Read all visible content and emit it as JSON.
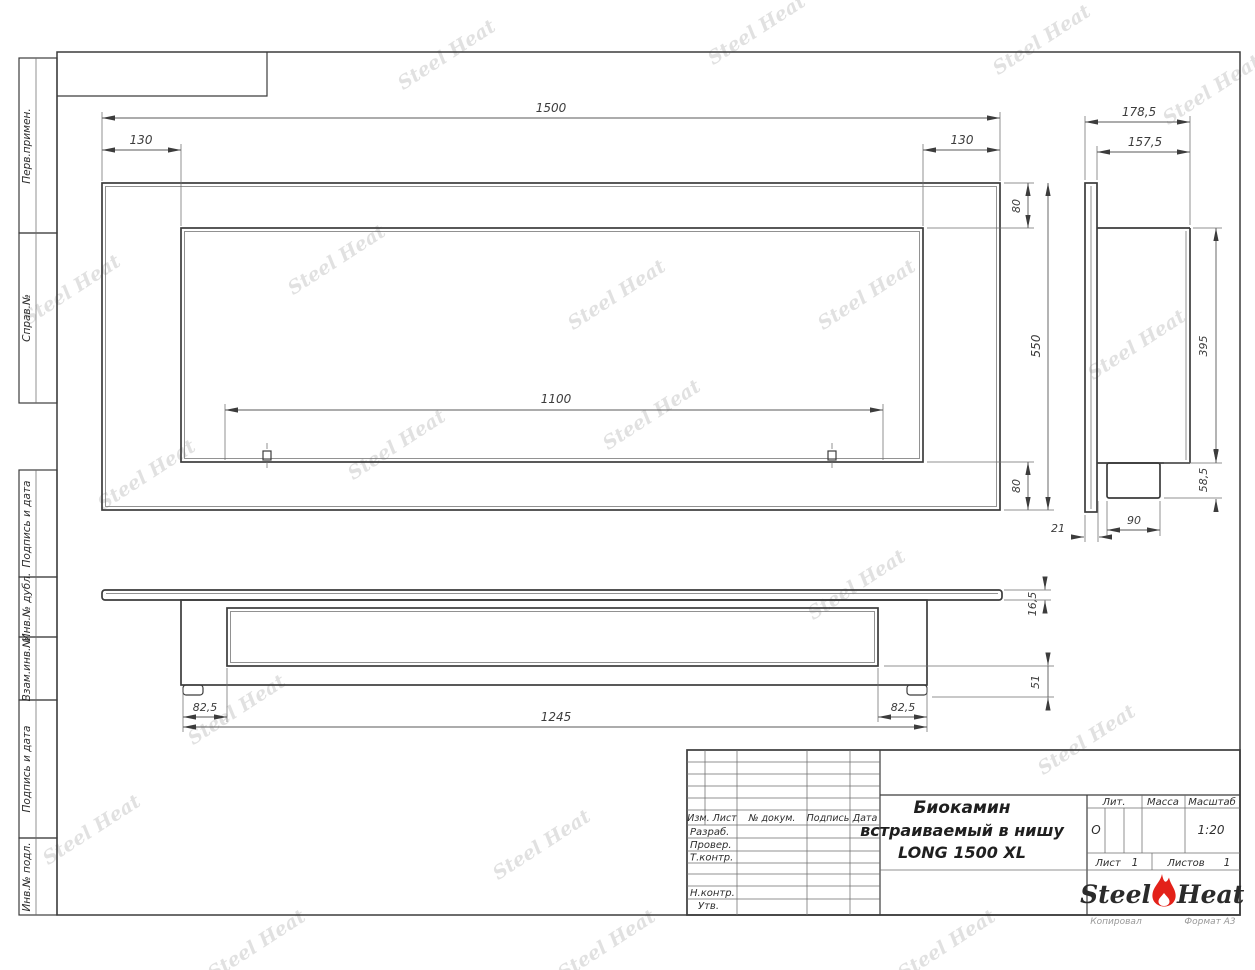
{
  "sheet": {
    "copied_note": "Копировал",
    "format_note": "Формат А3"
  },
  "margin_columns": {
    "perv_primen": "Перв.примен.",
    "sprav_no": "Справ.№",
    "podpis_i_data_upper": "Подпись и дата",
    "inv_no_dubl": "Инв.№ дубл.",
    "vzam_inv_no": "Взам.инв.№",
    "podpis_i_data_lower": "Подпись и дата",
    "inv_no_podl": "Инв.№ подл."
  },
  "title_block": {
    "izm_list": "Изм. Лист",
    "no_dokum": "№ докум.",
    "podpis": "Подпись",
    "data": "Дата",
    "razrab": "Разраб.",
    "prover": "Провер.",
    "t_kontr": "Т.контр.",
    "n_kontr": "Н.контр.",
    "utv": "Утв.",
    "title_line1": "Биокамин",
    "title_line2": "встраиваемый в нишу",
    "title_line3": "LONG 1500 XL",
    "lit_label": "Лит.",
    "lit_value": "О",
    "massa_label": "Масса",
    "masshtab_label": "Масштаб",
    "masshtab_value": "1:20",
    "list_label": "Лист",
    "list_value": "1",
    "listov_label": "Листов",
    "listov_value": "1"
  },
  "logo": {
    "steel": "Steel",
    "heat": "Heat",
    "flame_color": "#e32119"
  },
  "watermark": {
    "text": "Steel Heat",
    "color": "#d7d7d7"
  },
  "dims": {
    "front": {
      "width_total": "1500",
      "inset_left": "130",
      "inset_right": "130",
      "border_top": "80",
      "height_total": "550",
      "border_bottom": "80",
      "opening_width": "1100"
    },
    "side": {
      "depth_total": "178,5",
      "depth_body": "157,5",
      "height_body": "395",
      "height_tray": "58,5",
      "width_tray": "90",
      "gap_front": "21"
    },
    "bottom": {
      "flange_thickness": "16,5",
      "body_length": "1245",
      "inset_left": "82,5",
      "inset_right": "82,5",
      "lower_depth": "51"
    }
  }
}
